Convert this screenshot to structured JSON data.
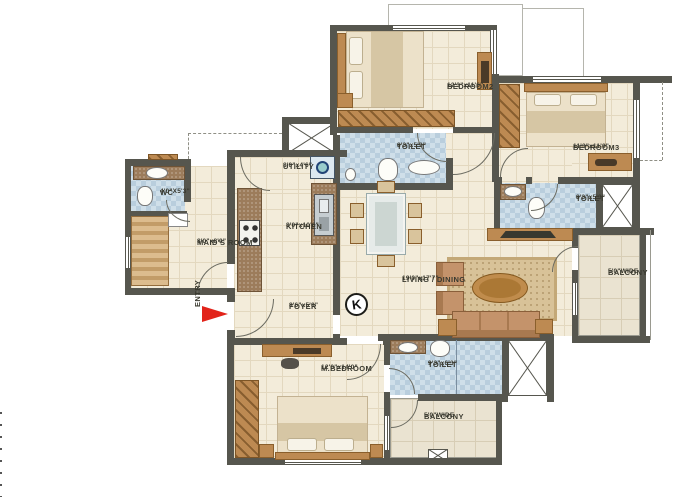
{
  "plan": {
    "rooms": {
      "bedroom2": {
        "name": "BEDROOM2",
        "dims": "12'3\"x11'6\""
      },
      "toilet2": {
        "name": "TOILET",
        "dims": "8'3\"x5'3\""
      },
      "bedroom3": {
        "name": "BEDROOM3",
        "dims": "11'3\"x11'0\""
      },
      "toilet3": {
        "name": "TOILET",
        "dims": "8'3\"x5'3\""
      },
      "balcony_right": {
        "name": "BALCONY",
        "dims": "5'0\"WIDE"
      },
      "wc": {
        "name": "WC",
        "dims": "4'0\"X5'3\""
      },
      "maids_room": {
        "name": "MAID'S ROOM",
        "dims": "8'0\"x8'0\""
      },
      "utility": {
        "name": "UTILITY",
        "dims": "8'0\"x4'6\""
      },
      "kitchen": {
        "name": "KITCHEN",
        "dims": "8'0\"x10'6\""
      },
      "living_dining": {
        "name": "LIVING / DINING",
        "dims": "19'0\"x17'7\""
      },
      "foyer": {
        "name": "FOYER",
        "dims": "8'6\"x5'0\""
      },
      "master_bedroom": {
        "name": "M.BEDROOM",
        "dims": "12'0\"x14'0\""
      },
      "toilet_master": {
        "name": "TOILET",
        "dims": "9'3\"x6'3\""
      },
      "balcony_bottom": {
        "name": "BALCONY",
        "dims": "5'0\"WIDE"
      }
    },
    "entry_label": "ENTRY",
    "compass_label": "K",
    "colors": {
      "wall": "#56564e",
      "floor": "#f3ecda",
      "toilet_tile": "#cfdfe9",
      "wood": "#bd8a52",
      "entry_arrow": "#e2231a"
    }
  }
}
